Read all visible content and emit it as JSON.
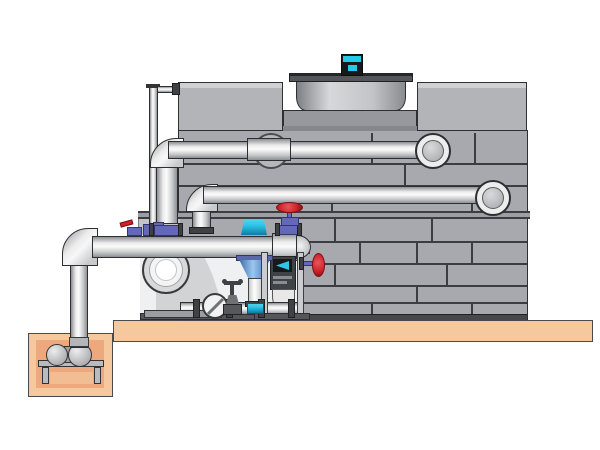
{
  "meta": {
    "title": "Cooling tower and pump skid installation illustration",
    "kind": "3d-technical-diagram",
    "visible_text": [],
    "canvas": {
      "width": 600,
      "height": 450
    }
  },
  "palette": {
    "bg": "#ffffff",
    "pad": "#f5c89e",
    "pit": "#eda87e",
    "pit-light": "#f3bd94",
    "tower-face": "#a7a9ae",
    "tower-light": "#b2b4b8",
    "tower-recess": "#96989d",
    "band": "#9c9ea3",
    "base": "#46484c",
    "seam": "#3b3d41",
    "outline": "#2e2f32",
    "pipe-light": "#ececec",
    "pipe-mid": "#c9cacc",
    "pipe-dark": "#8e8f93",
    "flange": "#3f4144",
    "bay": "#eef0f1",
    "motor-cyan": "#25c9ea",
    "sensor-cyan": "#2ec5e6",
    "valve-blue": "#6468b8",
    "valve-blue-dark": "#33366b",
    "handle-red": "#cc2128",
    "handle-red-dark": "#7e1014",
    "frame-gray": "#caccd0",
    "stand-gray": "#b9bbbf",
    "casing-gray": "#d2d3d5"
  },
  "components": [
    {
      "name": "concrete-pad",
      "desc": "equipment foundation slab"
    },
    {
      "name": "sump-pit",
      "desc": "below-grade pit with horizontal pump on stand"
    },
    {
      "name": "suction-riser-pipe",
      "desc": "vertical pipe from sump pump to header"
    },
    {
      "name": "discharge-header-pipe",
      "desc": "horizontal header with capped end"
    },
    {
      "name": "circulation-pump",
      "desc": "end-suction centrifugal pump"
    },
    {
      "name": "upper-distribution-pipe",
      "desc": "hot water inlet pipe to tower, upper"
    },
    {
      "name": "lower-distribution-pipe",
      "desc": "hot water inlet pipe to tower, lower"
    },
    {
      "name": "standpipe-vent",
      "desc": "thin equalizer pipe to tower top"
    },
    {
      "name": "cooling-tower-body",
      "desc": "panelized counterflow cooling tower"
    },
    {
      "name": "fan-shroud",
      "desc": "cylindrical fan cowl on tower deck"
    },
    {
      "name": "fan-motor",
      "desc": "cyan direct-drive fan motor"
    },
    {
      "name": "control-valve",
      "desc": "actuated valve with funnel actuator"
    },
    {
      "name": "sensor-transmitter",
      "desc": "cyan instrument on header"
    },
    {
      "name": "globe-valve-red",
      "desc": "red handwheel valve on header end"
    },
    {
      "name": "side-valve-red",
      "desc": "red handwheel valve on instrument frame"
    },
    {
      "name": "instrument-frame",
      "desc": "stand with display and drain elbow"
    },
    {
      "name": "check-valve",
      "desc": "wafer check valve on skid piping"
    },
    {
      "name": "gate-valve-small",
      "desc": "small cross-handle valve on skid piping"
    }
  ]
}
